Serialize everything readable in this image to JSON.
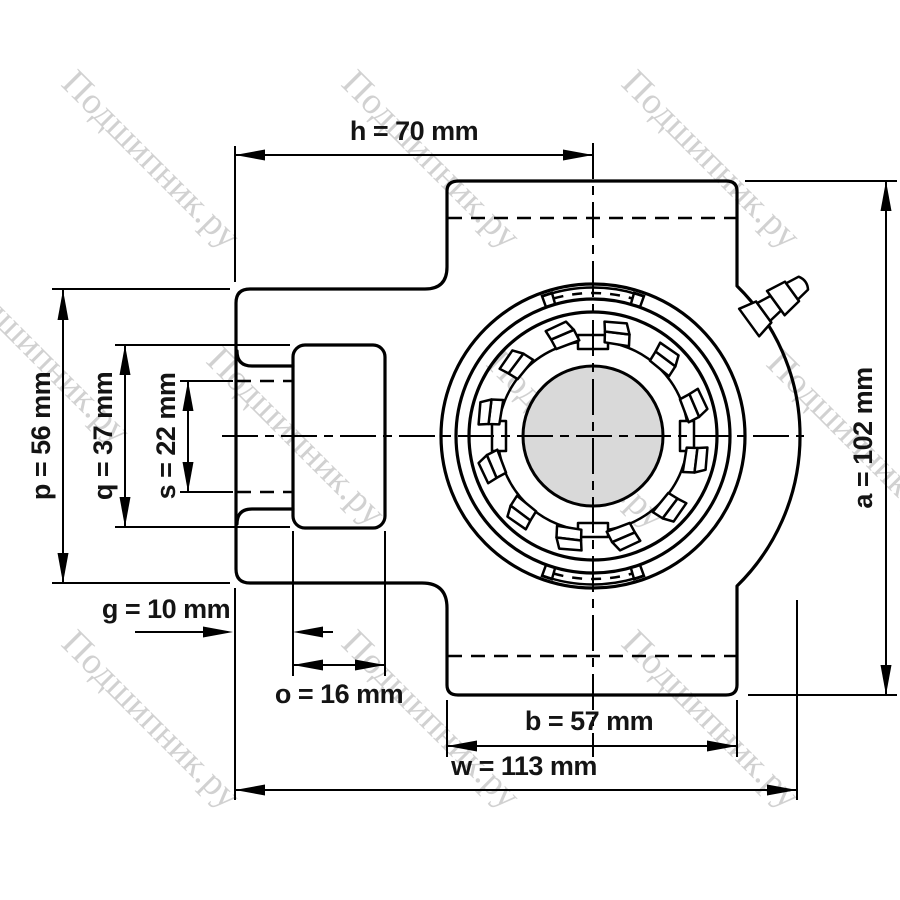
{
  "watermark": {
    "text": "Подшипник.ру"
  },
  "colors": {
    "line": "#000000",
    "shaft_fill": "#d9d9d9",
    "watermark": "#c9c9c9",
    "background": "#ffffff"
  },
  "dimensions": {
    "h": {
      "name": "h",
      "value": 70,
      "unit": "mm",
      "label": "h = 70 mm"
    },
    "a": {
      "name": "a",
      "value": 102,
      "unit": "mm",
      "label": "a = 102 mm"
    },
    "p": {
      "name": "p",
      "value": 56,
      "unit": "mm",
      "label": "p = 56 mm"
    },
    "q": {
      "name": "q",
      "value": 37,
      "unit": "mm",
      "label": "q = 37 mm"
    },
    "s": {
      "name": "s",
      "value": 22,
      "unit": "mm",
      "label": "s = 22 mm"
    },
    "g": {
      "name": "g",
      "value": 10,
      "unit": "mm",
      "label": "g = 10 mm"
    },
    "o": {
      "name": "o",
      "value": 16,
      "unit": "mm",
      "label": "o = 16 mm"
    },
    "b": {
      "name": "b",
      "value": 57,
      "unit": "mm",
      "label": "b = 57 mm"
    },
    "w": {
      "name": "w",
      "value": 113,
      "unit": "mm",
      "label": "w = 113 mm"
    }
  }
}
